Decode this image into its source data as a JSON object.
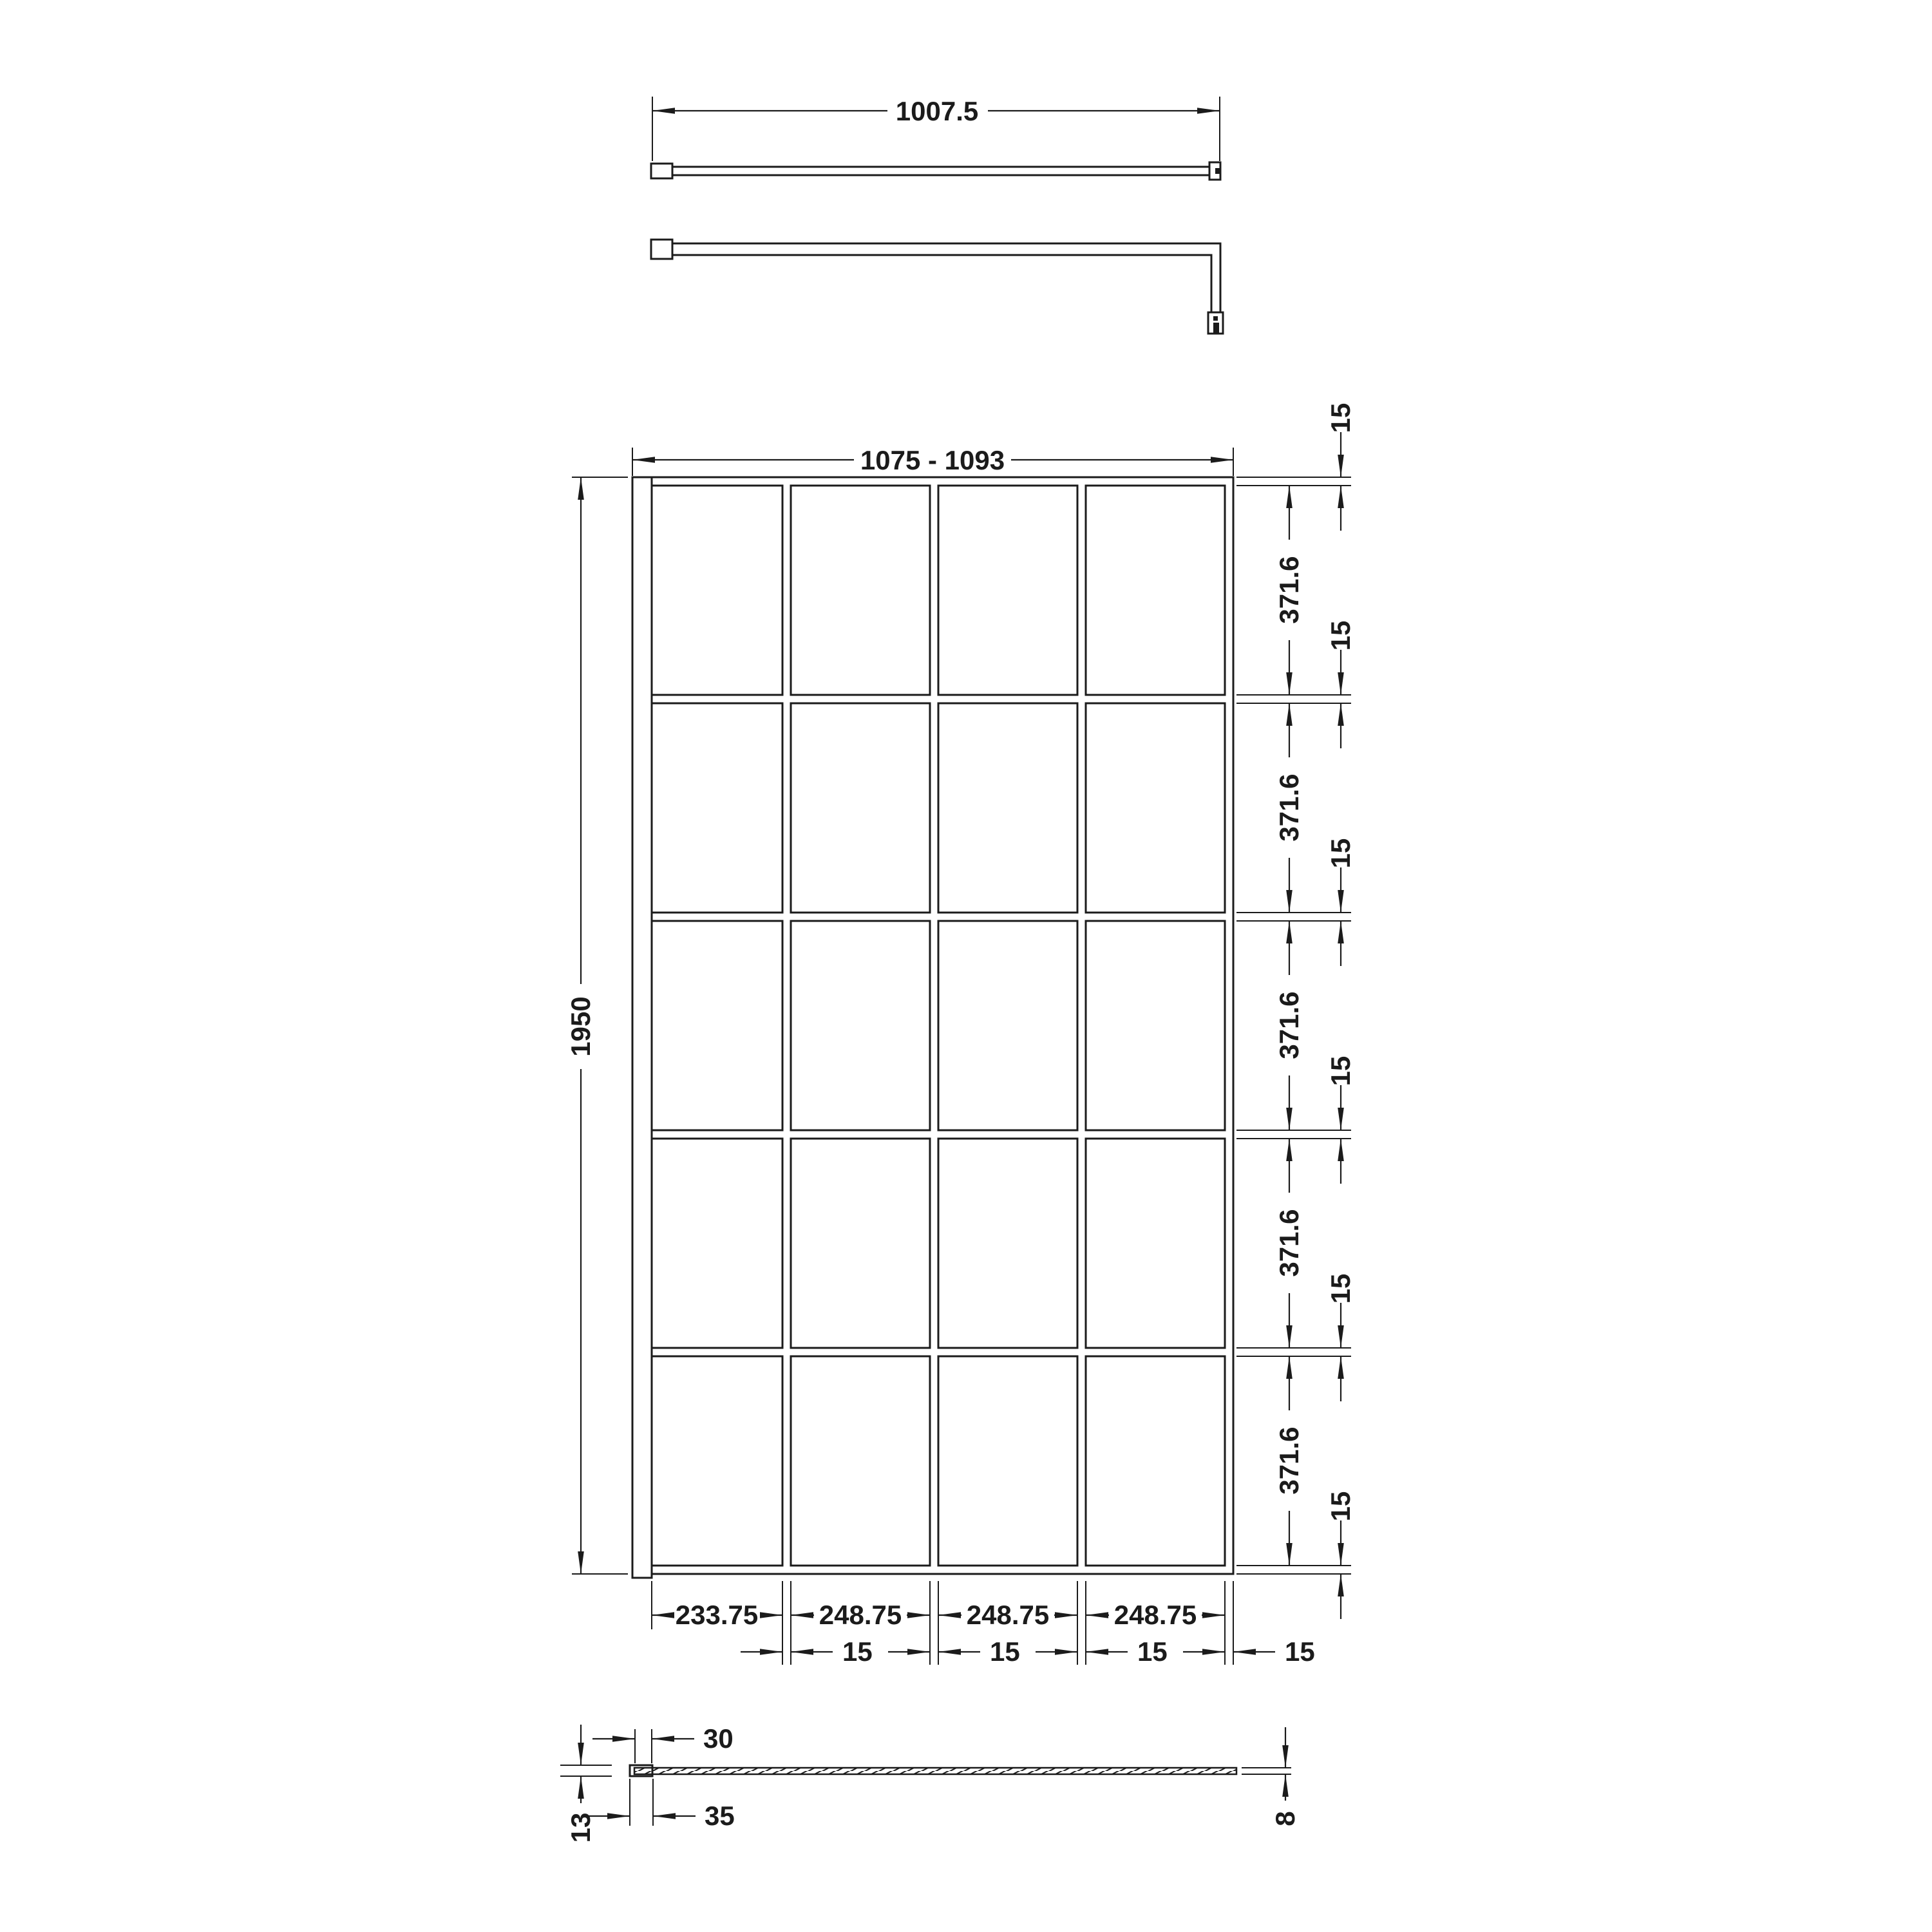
{
  "colors": {
    "line": "#1b1b1b",
    "background": "#ffffff"
  },
  "views": {
    "support_bar_top": {
      "width": "1007.5"
    },
    "front": {
      "overall_width": "1075 - 1093",
      "overall_height": "1950",
      "panel_heights": [
        "371.6",
        "371.6",
        "371.6",
        "371.6",
        "371.6"
      ],
      "rail_thicknesses": [
        "15",
        "15",
        "15",
        "15",
        "15",
        "15"
      ],
      "panel_widths": [
        "233.75",
        "248.75",
        "248.75",
        "248.75"
      ],
      "mullion_widths": [
        "15",
        "15",
        "15",
        "15"
      ]
    },
    "profile": {
      "channel_opening": "30",
      "channel_width": "35",
      "channel_depth": "13",
      "glass_thickness": "8"
    }
  }
}
